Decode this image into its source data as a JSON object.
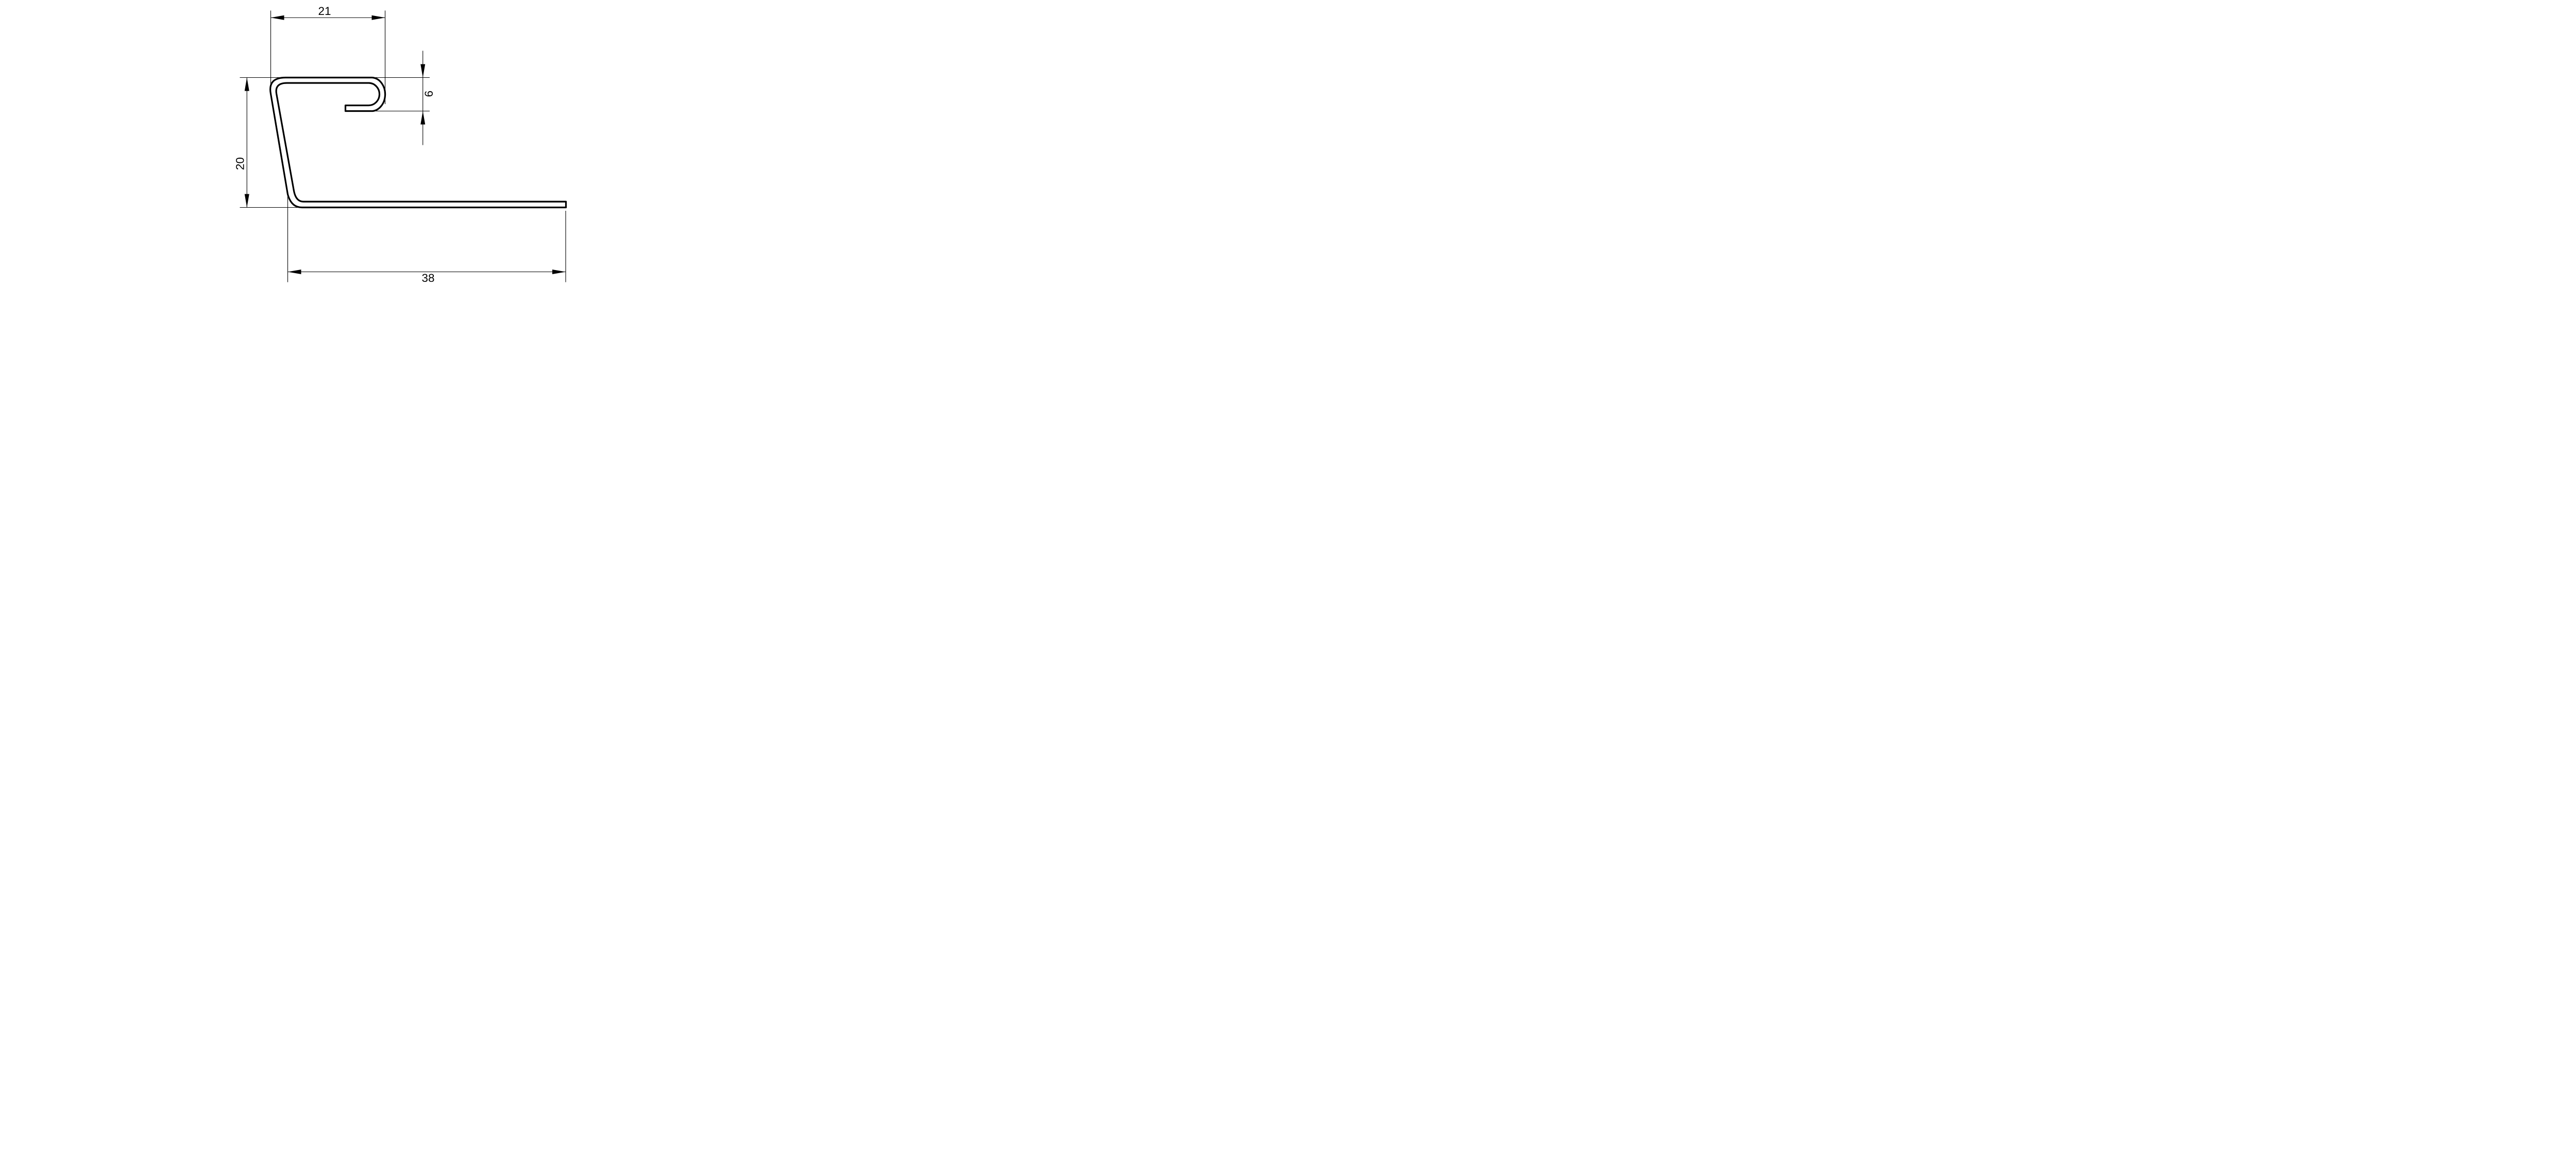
{
  "drawing": {
    "kind": "profile-cross-section-technical-drawing",
    "background_color": "#ffffff",
    "line_color": "#000000",
    "dimensions": {
      "top_width": {
        "label": "21",
        "value": 21,
        "orientation": "horizontal"
      },
      "left_height": {
        "label": "20",
        "value": 20,
        "orientation": "vertical"
      },
      "hook_gap": {
        "label": "6",
        "value": 6,
        "orientation": "vertical"
      },
      "base_width": {
        "label": "38",
        "value": 38,
        "orientation": "horizontal"
      }
    }
  }
}
